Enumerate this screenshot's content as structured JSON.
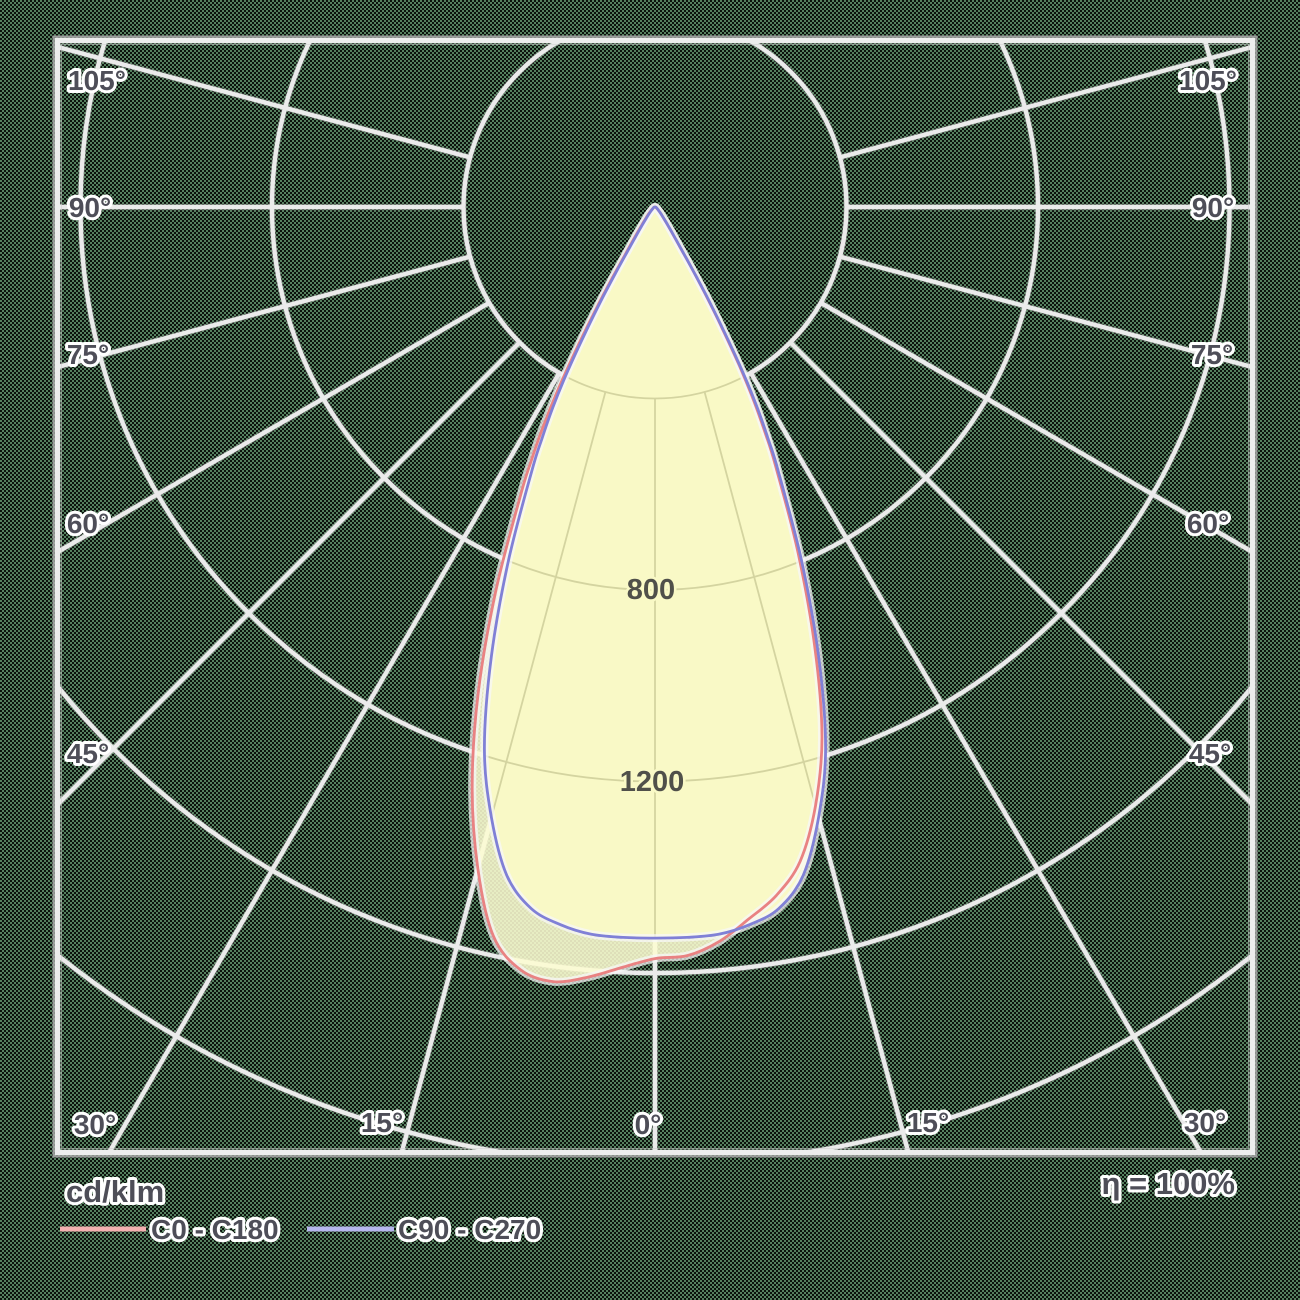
{
  "title": "Polar luminous intensity distribution diagram",
  "footer": {
    "unit_label": "cd/klm",
    "efficiency_label": "η = 100%"
  },
  "legend": [
    {
      "label": "C0 - C180",
      "swatch_color": "#f3b0b0"
    },
    {
      "label": "C90 - C270",
      "swatch_color": "#b6b6ee"
    }
  ],
  "chart_data": {
    "type": "polar-photometric",
    "unit": "cd/klm",
    "efficiency_percent": 100,
    "angle_step_deg": 15,
    "max_angle_deg": 105,
    "ring_values": [
      400,
      800,
      1200,
      1600,
      2000
    ],
    "ring_label_annotations": [
      {
        "text": "800",
        "x": 651,
        "y": 589
      },
      {
        "text": "1200",
        "x": 652,
        "y": 781
      }
    ],
    "angle_label_annotations": [
      {
        "text": "105°",
        "x": 97,
        "y": 80
      },
      {
        "text": "90°",
        "x": 90,
        "y": 207
      },
      {
        "text": "75°",
        "x": 88,
        "y": 354
      },
      {
        "text": "60°",
        "x": 88,
        "y": 523
      },
      {
        "text": "45°",
        "x": 88,
        "y": 753
      },
      {
        "text": "30°",
        "x": 95,
        "y": 1124
      },
      {
        "text": "15°",
        "x": 382,
        "y": 1122
      },
      {
        "text": "0°",
        "x": 648,
        "y": 1124
      },
      {
        "text": "15°",
        "x": 928,
        "y": 1122
      },
      {
        "text": "30°",
        "x": 1205,
        "y": 1122
      },
      {
        "text": "45°",
        "x": 1210,
        "y": 753
      },
      {
        "text": "60°",
        "x": 1208,
        "y": 523
      },
      {
        "text": "75°",
        "x": 1212,
        "y": 354
      },
      {
        "text": "90°",
        "x": 1213,
        "y": 207
      },
      {
        "text": "105°",
        "x": 1208,
        "y": 80
      }
    ],
    "style": {
      "outer_grid_color": "#ebebeb",
      "grid_shadow_color": "#b9b9b9",
      "inner_grid_color": "#d4d4a0",
      "frame_outer_color": "#9b9b9b",
      "frame_inner_color": "#ededed",
      "fill_color": "#f9f9c6",
      "fill_color_c0": "rgba(252,252,210,0.88)"
    },
    "series": [
      {
        "name": "C0 - C180",
        "stroke": "#e98282",
        "points": [
          [
            -90,
            0
          ],
          [
            -75,
            2
          ],
          [
            -60,
            4
          ],
          [
            -50,
            9
          ],
          [
            -45,
            15
          ],
          [
            -40,
            28
          ],
          [
            -36,
            48
          ],
          [
            -34,
            72
          ],
          [
            -32,
            120
          ],
          [
            -31,
            175
          ],
          [
            -30,
            250
          ],
          [
            -29,
            335
          ],
          [
            -28,
            430
          ],
          [
            -27,
            515
          ],
          [
            -26,
            590
          ],
          [
            -25,
            665
          ],
          [
            -22.5,
            870
          ],
          [
            -20,
            1080
          ],
          [
            -17.5,
            1270
          ],
          [
            -15,
            1430
          ],
          [
            -12.5,
            1560
          ],
          [
            -10,
            1618
          ],
          [
            -7.5,
            1632
          ],
          [
            -5,
            1615
          ],
          [
            -2.5,
            1590
          ],
          [
            0,
            1570
          ],
          [
            2.5,
            1565
          ],
          [
            5,
            1540
          ],
          [
            7.5,
            1500
          ],
          [
            10,
            1460
          ],
          [
            12.5,
            1400
          ],
          [
            15,
            1295
          ],
          [
            17.5,
            1160
          ],
          [
            20,
            975
          ],
          [
            22.5,
            780
          ],
          [
            25,
            595
          ],
          [
            26,
            525
          ],
          [
            27,
            455
          ],
          [
            28,
            375
          ],
          [
            29,
            288
          ],
          [
            30,
            212
          ],
          [
            31,
            145
          ],
          [
            32,
            97
          ],
          [
            34,
            58
          ],
          [
            36,
            38
          ],
          [
            40,
            21
          ],
          [
            45,
            11
          ],
          [
            50,
            7
          ],
          [
            60,
            3
          ],
          [
            75,
            2
          ],
          [
            90,
            0
          ]
        ]
      },
      {
        "name": "C90 - C270",
        "stroke": "#8080d6",
        "points": [
          [
            -90,
            0
          ],
          [
            -75,
            2
          ],
          [
            -60,
            4
          ],
          [
            -50,
            8
          ],
          [
            -45,
            12
          ],
          [
            -40,
            22
          ],
          [
            -36,
            40
          ],
          [
            -34,
            60
          ],
          [
            -32,
            100
          ],
          [
            -31,
            150
          ],
          [
            -30,
            220
          ],
          [
            -29,
            300
          ],
          [
            -28,
            390
          ],
          [
            -27,
            470
          ],
          [
            -26,
            540
          ],
          [
            -25,
            610
          ],
          [
            -22.5,
            800
          ],
          [
            -20,
            1000
          ],
          [
            -17.5,
            1185
          ],
          [
            -15,
            1320
          ],
          [
            -12.5,
            1430
          ],
          [
            -10,
            1488
          ],
          [
            -7.5,
            1512
          ],
          [
            -5,
            1525
          ],
          [
            -2.5,
            1527
          ],
          [
            0,
            1527
          ],
          [
            2.5,
            1527
          ],
          [
            5,
            1525
          ],
          [
            7.5,
            1512
          ],
          [
            10,
            1488
          ],
          [
            12.5,
            1430
          ],
          [
            15,
            1320
          ],
          [
            17.5,
            1185
          ],
          [
            20,
            1000
          ],
          [
            22.5,
            800
          ],
          [
            25,
            610
          ],
          [
            26,
            540
          ],
          [
            27,
            470
          ],
          [
            28,
            390
          ],
          [
            29,
            300
          ],
          [
            30,
            220
          ],
          [
            31,
            150
          ],
          [
            32,
            100
          ],
          [
            34,
            60
          ],
          [
            36,
            40
          ],
          [
            40,
            22
          ],
          [
            45,
            12
          ],
          [
            50,
            8
          ],
          [
            60,
            4
          ],
          [
            75,
            2
          ],
          [
            90,
            0
          ]
        ]
      }
    ]
  }
}
